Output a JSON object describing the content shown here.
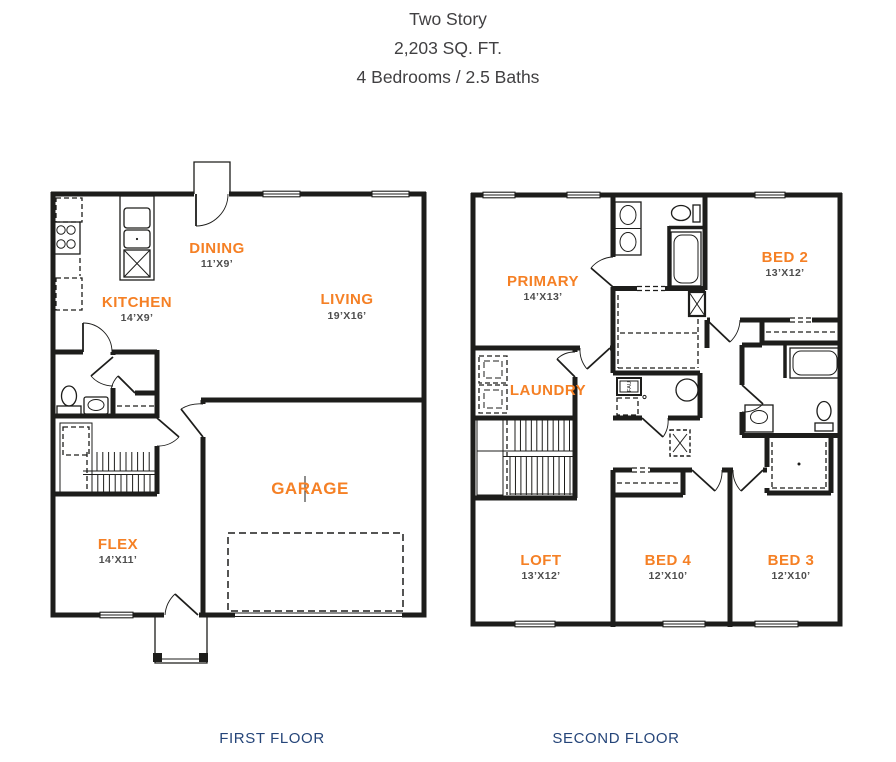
{
  "header": {
    "title": "Two Story",
    "sqft": "2,203 SQ. FT.",
    "beds_baths": "4 Bedrooms / 2.5 Baths"
  },
  "floors": {
    "first": {
      "title": "FIRST FLOOR",
      "rooms": {
        "dining": {
          "name": "DINING",
          "dims": "11’X9’"
        },
        "kitchen": {
          "name": "KITCHEN",
          "dims": "14’X9’"
        },
        "living": {
          "name": "LIVING",
          "dims": "19’X16’"
        },
        "garage": {
          "name": "GARAGE",
          "dims": ""
        },
        "flex": {
          "name": "FLEX",
          "dims": "14’X11’"
        }
      }
    },
    "second": {
      "title": "SECOND FLOOR",
      "rooms": {
        "primary": {
          "name": "PRIMARY",
          "dims": "14’X13’"
        },
        "bed2": {
          "name": "BED 2",
          "dims": "13’X12’"
        },
        "laundry": {
          "name": "LAUNDRY",
          "dims": ""
        },
        "loft": {
          "name": "LOFT",
          "dims": "13’X12’"
        },
        "bed4": {
          "name": "BED 4",
          "dims": "12’X10’"
        },
        "bed3": {
          "name": "BED 3",
          "dims": "12’X10’"
        }
      }
    }
  },
  "labels": {
    "fau": "FAU"
  },
  "colors": {
    "accent_orange": "#F58025",
    "dimension_text": "#4D4D4D",
    "wall": "#1D1D1B",
    "floor_title_navy": "#254579"
  }
}
